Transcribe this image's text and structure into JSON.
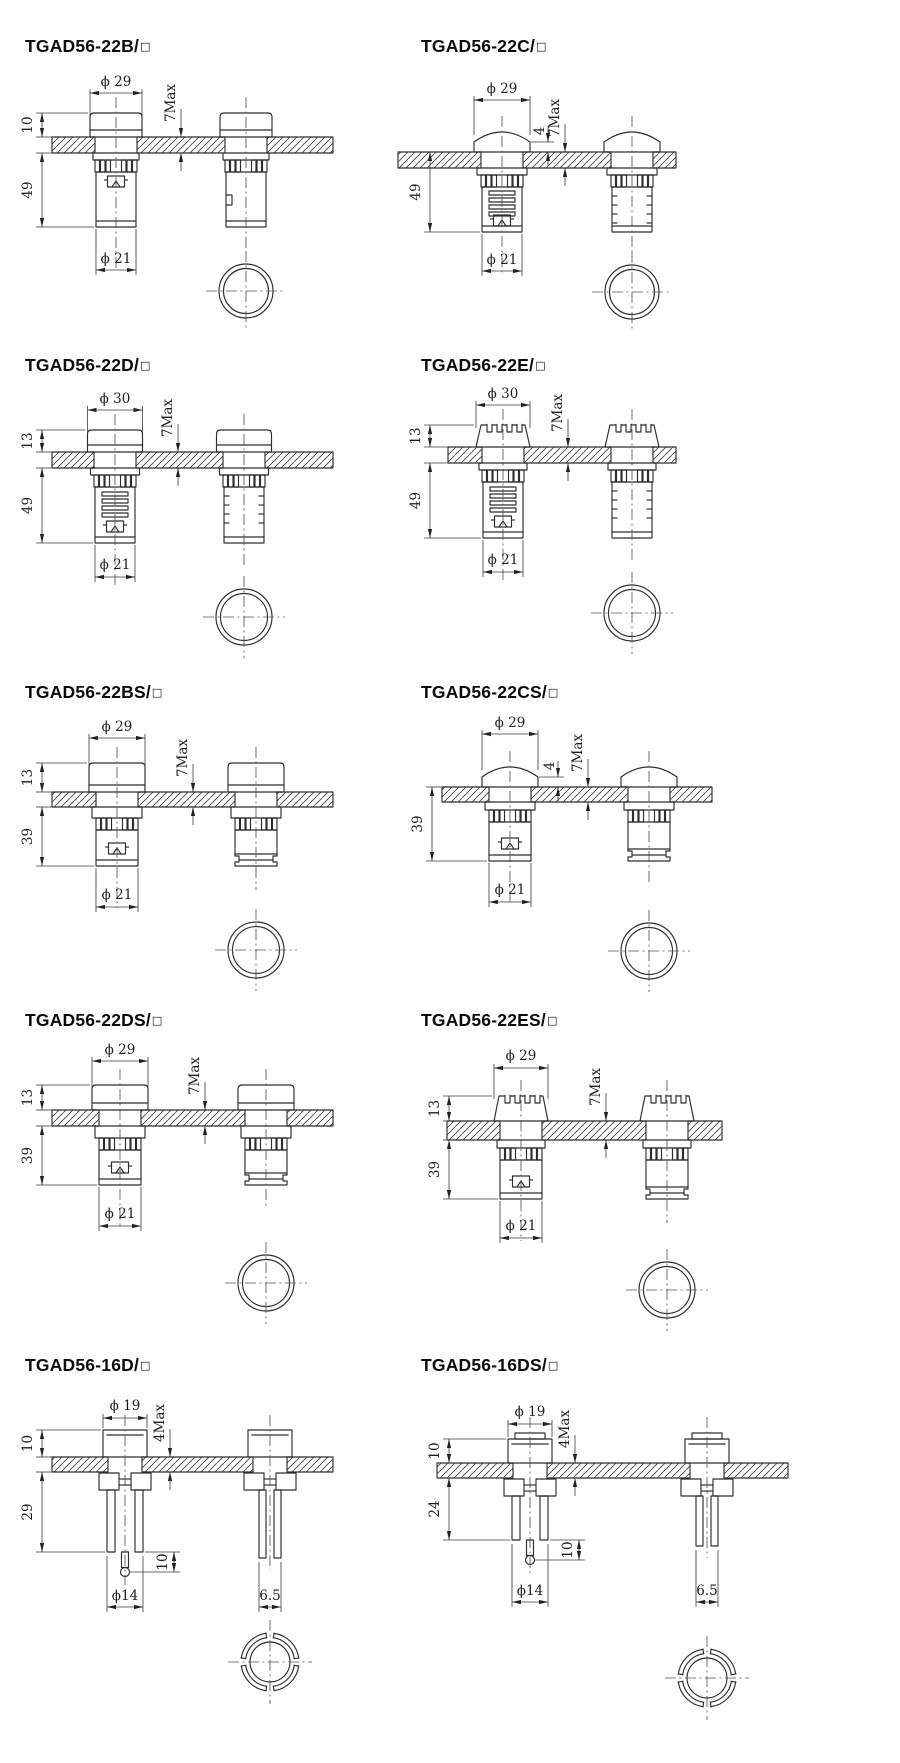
{
  "colors": {
    "line": "#2d2d2d",
    "title": "#0c0c0c",
    "background": "#ffffff"
  },
  "panels": [
    {
      "title_main": "TGAD56-22B/",
      "suffix": "□",
      "dims": {
        "top_dia": "ϕ 29",
        "cap_h": "10",
        "body_len": "49",
        "panel_max": "7Max",
        "bot_dia": "ϕ 21"
      }
    },
    {
      "title_main": "TGAD56-22C/",
      "suffix": "□",
      "dims": {
        "top_dia": "ϕ 29",
        "body_len": "49",
        "bezel": "4",
        "panel_max": "7Max",
        "bot_dia": "ϕ 21"
      }
    },
    {
      "title_main": "TGAD56-22D/",
      "suffix": "□",
      "dims": {
        "top_dia": "ϕ 30",
        "cap_h": "13",
        "body_len": "49",
        "panel_max": "7Max",
        "bot_dia": "ϕ 21"
      }
    },
    {
      "title_main": "TGAD56-22E/",
      "suffix": "□",
      "dims": {
        "top_dia": "ϕ 30",
        "cap_h": "13",
        "body_len": "49",
        "panel_max": "7Max",
        "bot_dia": "ϕ 21"
      }
    },
    {
      "title_main": "TGAD56-22BS/",
      "suffix": "□",
      "dims": {
        "top_dia": "ϕ 29",
        "cap_h": "13",
        "body_len": "39",
        "panel_max": "7Max",
        "bot_dia": "ϕ 21"
      }
    },
    {
      "title_main": "TGAD56-22CS/",
      "suffix": "□",
      "dims": {
        "top_dia": "ϕ 29",
        "body_len": "39",
        "bezel": "4",
        "panel_max": "7Max",
        "bot_dia": "ϕ 21"
      }
    },
    {
      "title_main": "TGAD56-22DS/",
      "suffix": "□",
      "dims": {
        "top_dia": "ϕ 29",
        "cap_h": "13",
        "body_len": "39",
        "panel_max": "7Max",
        "bot_dia": "ϕ 21"
      }
    },
    {
      "title_main": "TGAD56-22ES/",
      "suffix": "□",
      "dims": {
        "top_dia": "ϕ 29",
        "cap_h": "13",
        "body_len": "39",
        "panel_max": "7Max",
        "bot_dia": "ϕ 21"
      }
    },
    {
      "title_main": "TGAD56-16D/",
      "suffix": "□",
      "dims": {
        "top_dia": "ϕ 19",
        "cap_h": "10",
        "body_len": "29",
        "panel_max": "4Max",
        "bot_dia": "ϕ14",
        "pin_len": "10",
        "terminal_w": "6.5"
      }
    },
    {
      "title_main": "TGAD56-16DS/",
      "suffix": "□",
      "dims": {
        "top_dia": "ϕ 19",
        "cap_h": "10",
        "body_len": "24",
        "panel_max": "4Max",
        "bot_dia": "ϕ14",
        "pin_len": "10",
        "terminal_w": "6.5"
      }
    }
  ]
}
